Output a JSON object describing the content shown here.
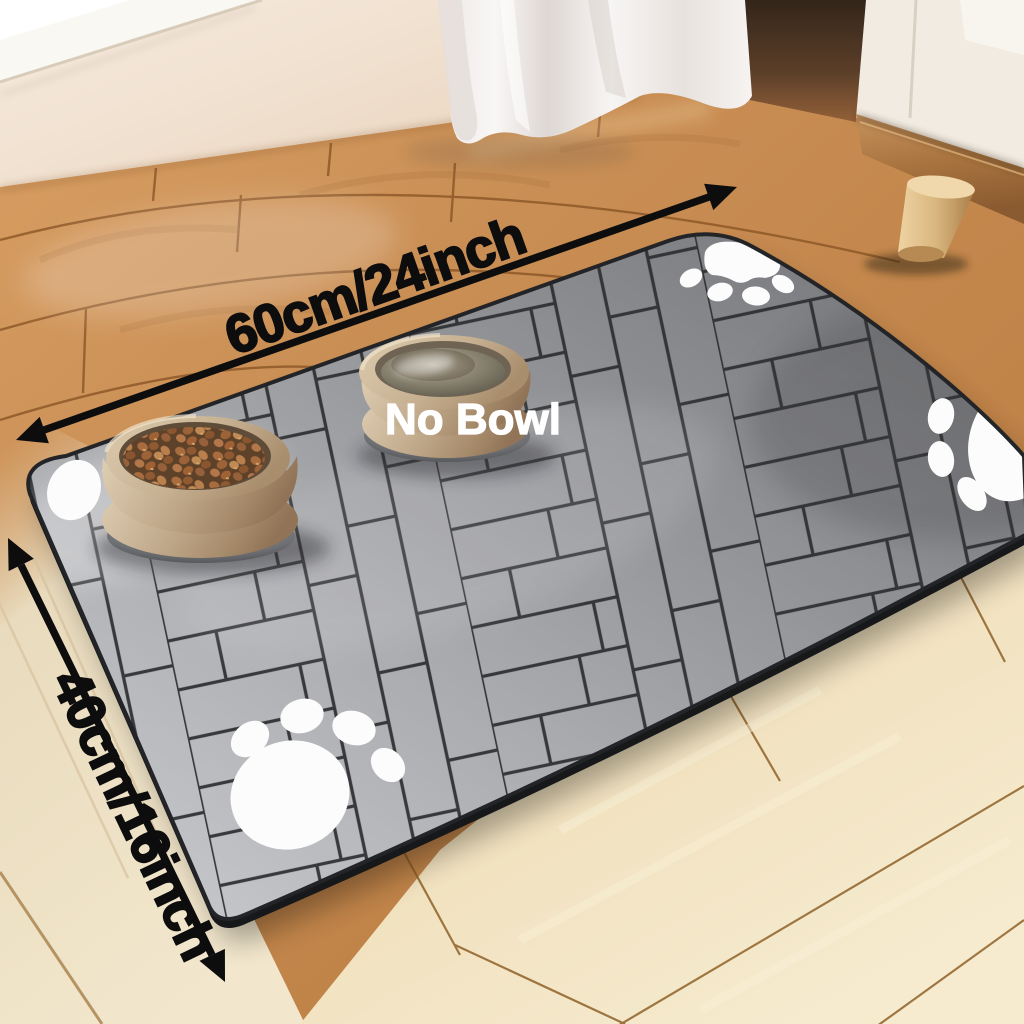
{
  "annotations": {
    "width_label": "60cm/24inch",
    "height_label": "40cm/16inch",
    "no_bowl_label": "No Bowl"
  },
  "colors": {
    "annotation_text": "#0d0d0e",
    "no_bowl_text": "#ffffff",
    "paw_white": "#fcfcfc",
    "mat_gray": "#a7a8ab",
    "mat_line": "#2c2d2f",
    "wood_warm": "#c9925f",
    "wood_light": "#f0e2c2",
    "bowl_tan": "#c2ab8e"
  },
  "icons": {
    "paw_print": "paw-print-icon",
    "dimension_arrow": "dimension-arrow"
  }
}
